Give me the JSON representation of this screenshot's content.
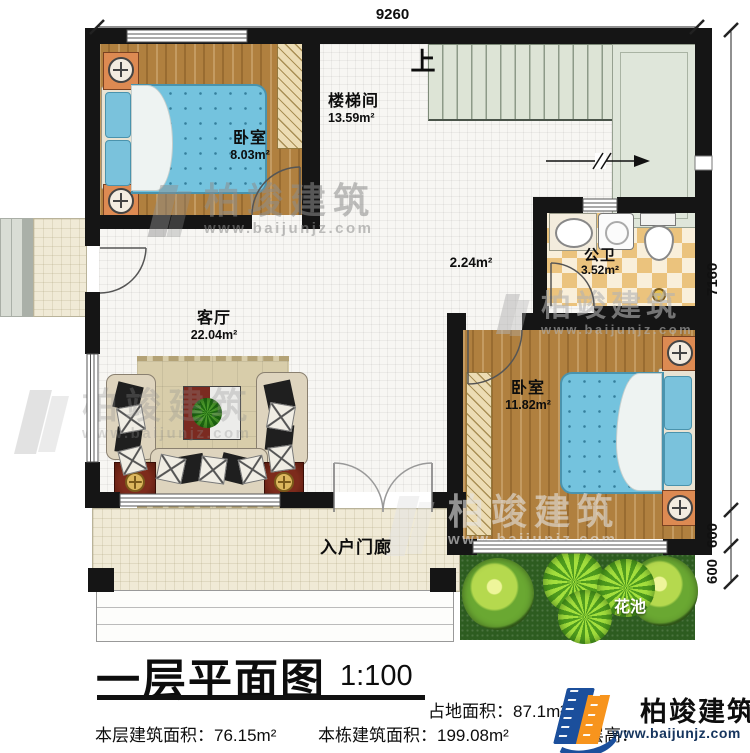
{
  "plan": {
    "dim_top": "9260",
    "dim_right_main": "7160",
    "dim_right_s1": "600",
    "dim_right_s2": "600",
    "stair_up": "上",
    "rooms": {
      "bedroom1": {
        "name": "卧室",
        "area": "8.03m²"
      },
      "stairwell": {
        "name": "楼梯间",
        "area": "13.59m²"
      },
      "bathroom": {
        "name": "公卫",
        "area": "3.52m²"
      },
      "bedroom2": {
        "name": "卧室",
        "area": "11.82m²"
      },
      "living": {
        "name": "客厅",
        "area": "22.04m²"
      },
      "corridor": {
        "area": "2.24m²"
      },
      "porch": {
        "name": "入户门廊"
      },
      "flowerbed": {
        "name": "花池"
      }
    }
  },
  "watermark": {
    "name": "柏竣建筑",
    "url": "www.baijunjz.com"
  },
  "footer": {
    "title": "一层平面图",
    "scale": "1:100",
    "land_label": "占地面积：",
    "land_value": "87.1m²",
    "floor_label": "本层建筑面积：",
    "floor_value": "76.15m²",
    "building_label": "本栋建筑面积：",
    "building_value": "199.08m²",
    "height_fragment": "（层高：",
    "brand": "柏竣建筑",
    "brand_url": "www.baijunjz.com",
    "brand_blue": "#1b4f9c",
    "brand_orange": "#f7941d"
  }
}
